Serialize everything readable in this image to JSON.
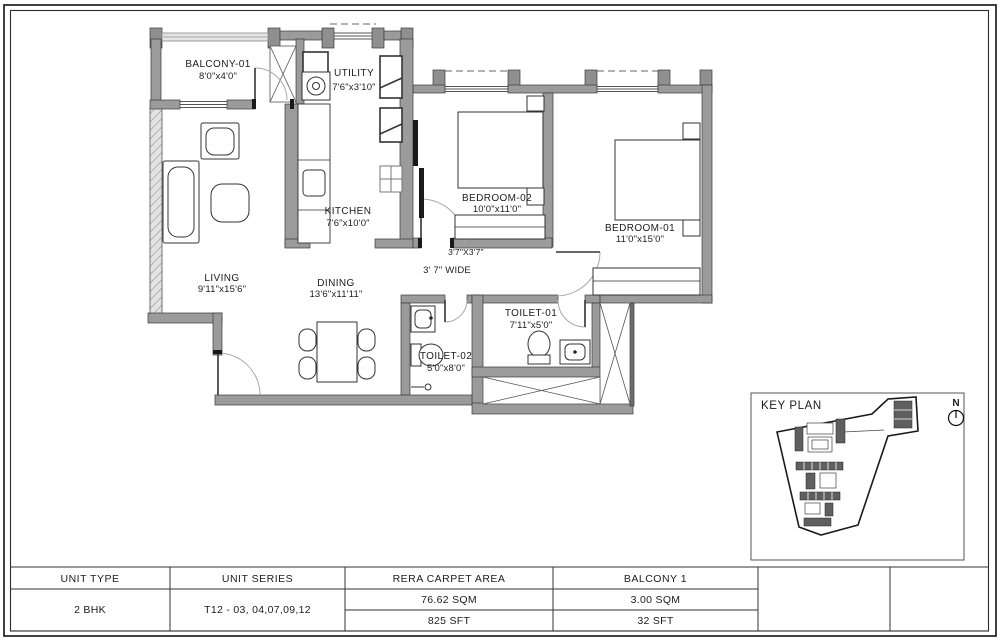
{
  "floor_plan": {
    "rooms": [
      {
        "name": "BALCONY-01",
        "dims": "8'0\"x4'0\""
      },
      {
        "name": "UTILITY",
        "dims": "7'6\"x3'10\""
      },
      {
        "name": "KITCHEN",
        "dims": "7'6\"x10'0\""
      },
      {
        "name": "BEDROOM-02",
        "dims": "10'0\"x11'0\""
      },
      {
        "name": "BEDROOM-01",
        "dims": "11'0\"x15'0\""
      },
      {
        "name": "LIVING",
        "dims": "9'11\"x15'6\""
      },
      {
        "name": "DINING",
        "dims": "13'6\"x11'11\""
      },
      {
        "name": "TOILET-01",
        "dims": "7'11\"x5'0\""
      },
      {
        "name": "TOILET-02",
        "dims": "5'0\"x8'0\""
      }
    ],
    "annotations": {
      "junction": "3'7\"X3'7\"",
      "passage": "3' 7\" WIDE"
    }
  },
  "key_plan": {
    "title": "KEY PLAN",
    "north_label": "N"
  },
  "table": {
    "columns": [
      {
        "header": "UNIT TYPE",
        "value": "2 BHK"
      },
      {
        "header": "UNIT SERIES",
        "value": "T12 - 03, 04,07,09,12"
      },
      {
        "header": "RERA CARPET AREA",
        "value_sqm": "76.62 SQM",
        "value_sft": "825 SFT"
      },
      {
        "header": "BALCONY 1",
        "value_sqm": "3.00 SQM",
        "value_sft": "32 SFT"
      }
    ]
  },
  "colors": {
    "wall": "#9b9b9b",
    "line": "#2b2b2b",
    "arc": "#a8a8a8"
  }
}
